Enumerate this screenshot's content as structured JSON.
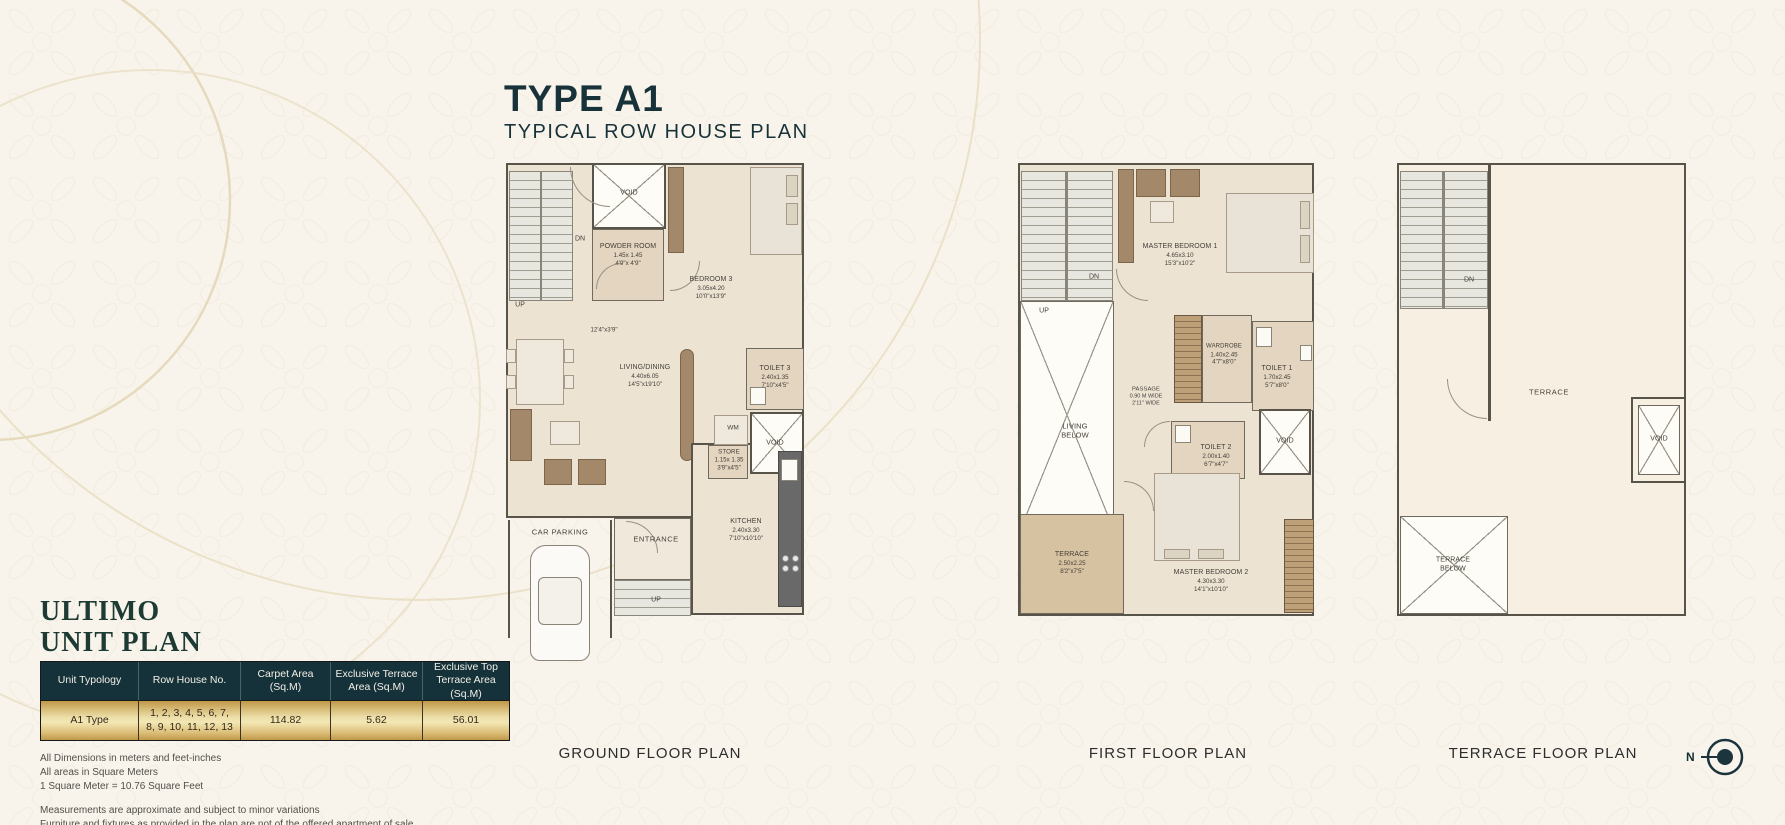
{
  "header": {
    "title": "TYPE A1",
    "subtitle": "TYPICAL ROW HOUSE  PLAN"
  },
  "unit_plan": {
    "brand": "ULTIMO",
    "heading": "UNIT PLAN",
    "table": {
      "headers": [
        "Unit Typology",
        "Row House No.",
        "Carpet Area (Sq.M)",
        "Exclusive Terrace Area (Sq.M)",
        "Exclusive Top Terrace Area (Sq.M)"
      ],
      "row": {
        "unit_typology": "A1 Type",
        "row_house_no": "1, 2, 3, 4, 5, 6, 7, 8, 9, 10, 11, 12, 13",
        "carpet_area": "114.82",
        "exclusive_terrace_area": "5.62",
        "exclusive_top_terrace_area": "56.01"
      }
    },
    "notes_dimensions": [
      "All Dimensions in meters and feet-inches",
      "All areas in Square Meters",
      "1 Square Meter = 10.76 Square Feet"
    ],
    "notes_disclaimer": [
      "Measurements are approximate and subject to minor variations",
      "Furniture and fixtures as provided in the plan are not of the offered apartment of sale"
    ]
  },
  "plans": {
    "ground": {
      "caption": "GROUND FLOOR PLAN",
      "rooms": {
        "void_upper": {
          "name": "VOID"
        },
        "powder_room": {
          "name": "POWDER ROOM",
          "m": "1.45x 1.45",
          "ft": "4'9\"x 4'9\""
        },
        "bedroom3": {
          "name": "BEDROOM 3",
          "m": "3.05x4.20",
          "ft": "10'0\"x13'9\""
        },
        "living_dining": {
          "name": "LIVING/DINING",
          "m": "4.40x6.05",
          "ft": "14'5\"x19'10\""
        },
        "passage_dim": {
          "name": "12'4\"x3'9\""
        },
        "toilet3": {
          "name": "TOILET 3",
          "m": "2.40x1.35",
          "ft": "7'10\"x4'5\""
        },
        "wm": {
          "name": "WM"
        },
        "store": {
          "name": "STORE",
          "m": "1.15x 1.35",
          "ft": "3'9\"x4'5\""
        },
        "void_lower": {
          "name": "VOID"
        },
        "kitchen": {
          "name": "KITCHEN",
          "m": "2.40x3.30",
          "ft": "7'10\"x10'10\""
        },
        "entrance": {
          "name": "ENTRANCE"
        },
        "car_parking": {
          "name": "CAR PARKING"
        },
        "up_stairs": {
          "name": "UP"
        },
        "dn_stairs": {
          "name": "DN"
        },
        "up_entry": {
          "name": "UP"
        }
      }
    },
    "first": {
      "caption": "FIRST FLOOR PLAN",
      "rooms": {
        "master_bedroom1": {
          "name": "MASTER  BEDROOM 1",
          "m": "4.65x3.10",
          "ft": "15'3\"x10'2\""
        },
        "wardrobe": {
          "name": "WARDROBE",
          "m": "1.40x2.45",
          "ft": "4'7\"x8'0\""
        },
        "toilet1": {
          "name": "TOILET 1",
          "m": "1.70x2.45",
          "ft": "5'7\"x8'0\""
        },
        "passage": {
          "name": "PASSAGE",
          "m": "0.90 M WIDE",
          "ft": "2'11\" WIDE"
        },
        "toilet2": {
          "name": "TOILET 2",
          "m": "2.00x1.40",
          "ft": "6'7\"x4'7\""
        },
        "void": {
          "name": "VOID"
        },
        "living_below": {
          "name": "LIVING",
          "name2": "BELOW"
        },
        "terrace": {
          "name": "TERRACE",
          "m": "2.50x2.25",
          "ft": "8'2\"x7'5\""
        },
        "master_bedroom2": {
          "name": "MASTER BEDROOM 2",
          "m": "4.30x3.30",
          "ft": "14'1\"x10'10\""
        },
        "up_stairs": {
          "name": "UP"
        },
        "dn_stairs": {
          "name": "DN"
        }
      }
    },
    "terrace": {
      "caption": "TERRACE  FLOOR PLAN",
      "rooms": {
        "terrace": {
          "name": "TERRACE"
        },
        "void": {
          "name": "VOID"
        },
        "terrace_below": {
          "name": "TERRACE",
          "name2": "BELOW"
        },
        "dn_stairs": {
          "name": "DN"
        }
      }
    }
  },
  "compass": {
    "label": "N"
  },
  "colors": {
    "accent_teal": "#15323a",
    "gold": "#d8b36a",
    "paper": "#f8f4ec",
    "room_beige": "#e3d5bf"
  }
}
